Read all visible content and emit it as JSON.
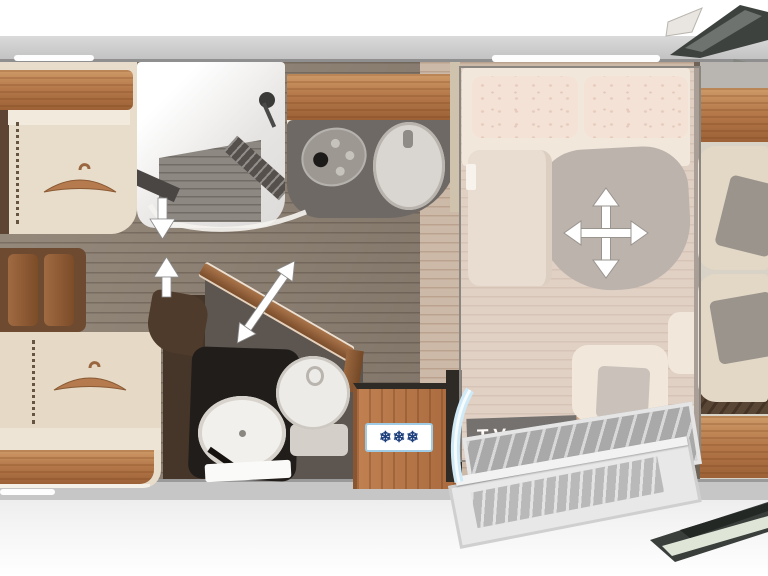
{
  "floorplan": {
    "labels": {
      "tv": "TV"
    },
    "fridge": {
      "snowflake_icon": "❄",
      "snowflake_count": 3,
      "snowflake_color": "#1d3f7c",
      "label_background": "#ffffff",
      "label_border": "#9fcce4"
    },
    "palette": {
      "wood_accent": "#b5794a",
      "upholstery_cream": "#e8ddcb",
      "counter_dark": "#6e6965",
      "bathroom_dark": "#5d5650",
      "corridor_floor": "#8e8173",
      "bedroom_floor": "#cdb9a8",
      "tv_bar": "#141414",
      "entry_door_glass": "#cfeaf6",
      "arrow": "#ffffff"
    },
    "indicators": [
      {
        "name": "wardrobe-arrow-down",
        "direction": "down"
      },
      {
        "name": "corridor-arrow-up",
        "direction": "up"
      },
      {
        "name": "swivel-wall-arrow",
        "direction": "diagonal-double"
      },
      {
        "name": "bed-move-cross",
        "direction": "four-way"
      }
    ]
  }
}
